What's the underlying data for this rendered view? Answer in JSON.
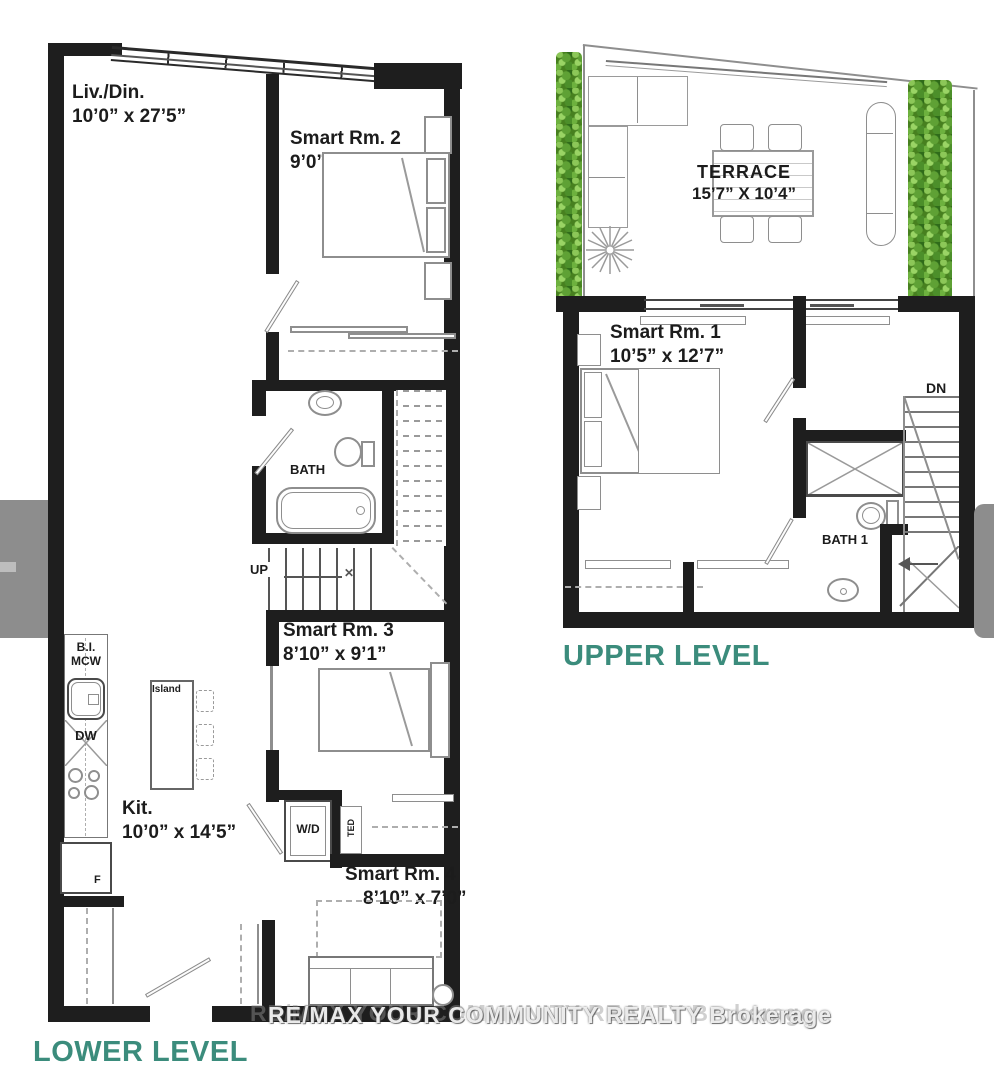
{
  "watermark": "RE/MAX YOUR COMMUNITY REALTY Brokerage",
  "lower": {
    "title": "LOWER LEVEL",
    "liv_din": {
      "name": "Liv./Din.",
      "dim": "10’0” x 27’5”"
    },
    "rm2": {
      "name": "Smart Rm. 2",
      "dim": "9’0” x 12’6”"
    },
    "bath": {
      "name": "BATH"
    },
    "up": "UP",
    "rm3": {
      "name": "Smart Rm. 3",
      "dim": "8’10” x 9’1”"
    },
    "kit": {
      "name": "Kit.",
      "dim": "10’0” x 14’5”"
    },
    "rm4": {
      "name": "Smart Rm. 4",
      "dim": "8’10” x 7’0”"
    },
    "bi": "B.I.",
    "mcw": "MCW",
    "dw": "DW",
    "island": "Island",
    "fridge": "F",
    "wd": "W/D",
    "ted": "TED"
  },
  "upper": {
    "title": "UPPER LEVEL",
    "terrace": {
      "name": "TERRACE",
      "dim": "15’7” X 10’4”"
    },
    "rm1": {
      "name": "Smart Rm. 1",
      "dim": "10’5” x 12’7”"
    },
    "bath1": {
      "name": "BATH 1"
    },
    "dn": "DN"
  },
  "colors": {
    "accent_teal": "#3B8C7C",
    "wall_black": "#1E1E1E",
    "hedge_green": "#47801F",
    "overlay_gray": "#8D8D8D",
    "line_gray": "#8E8E8E"
  }
}
